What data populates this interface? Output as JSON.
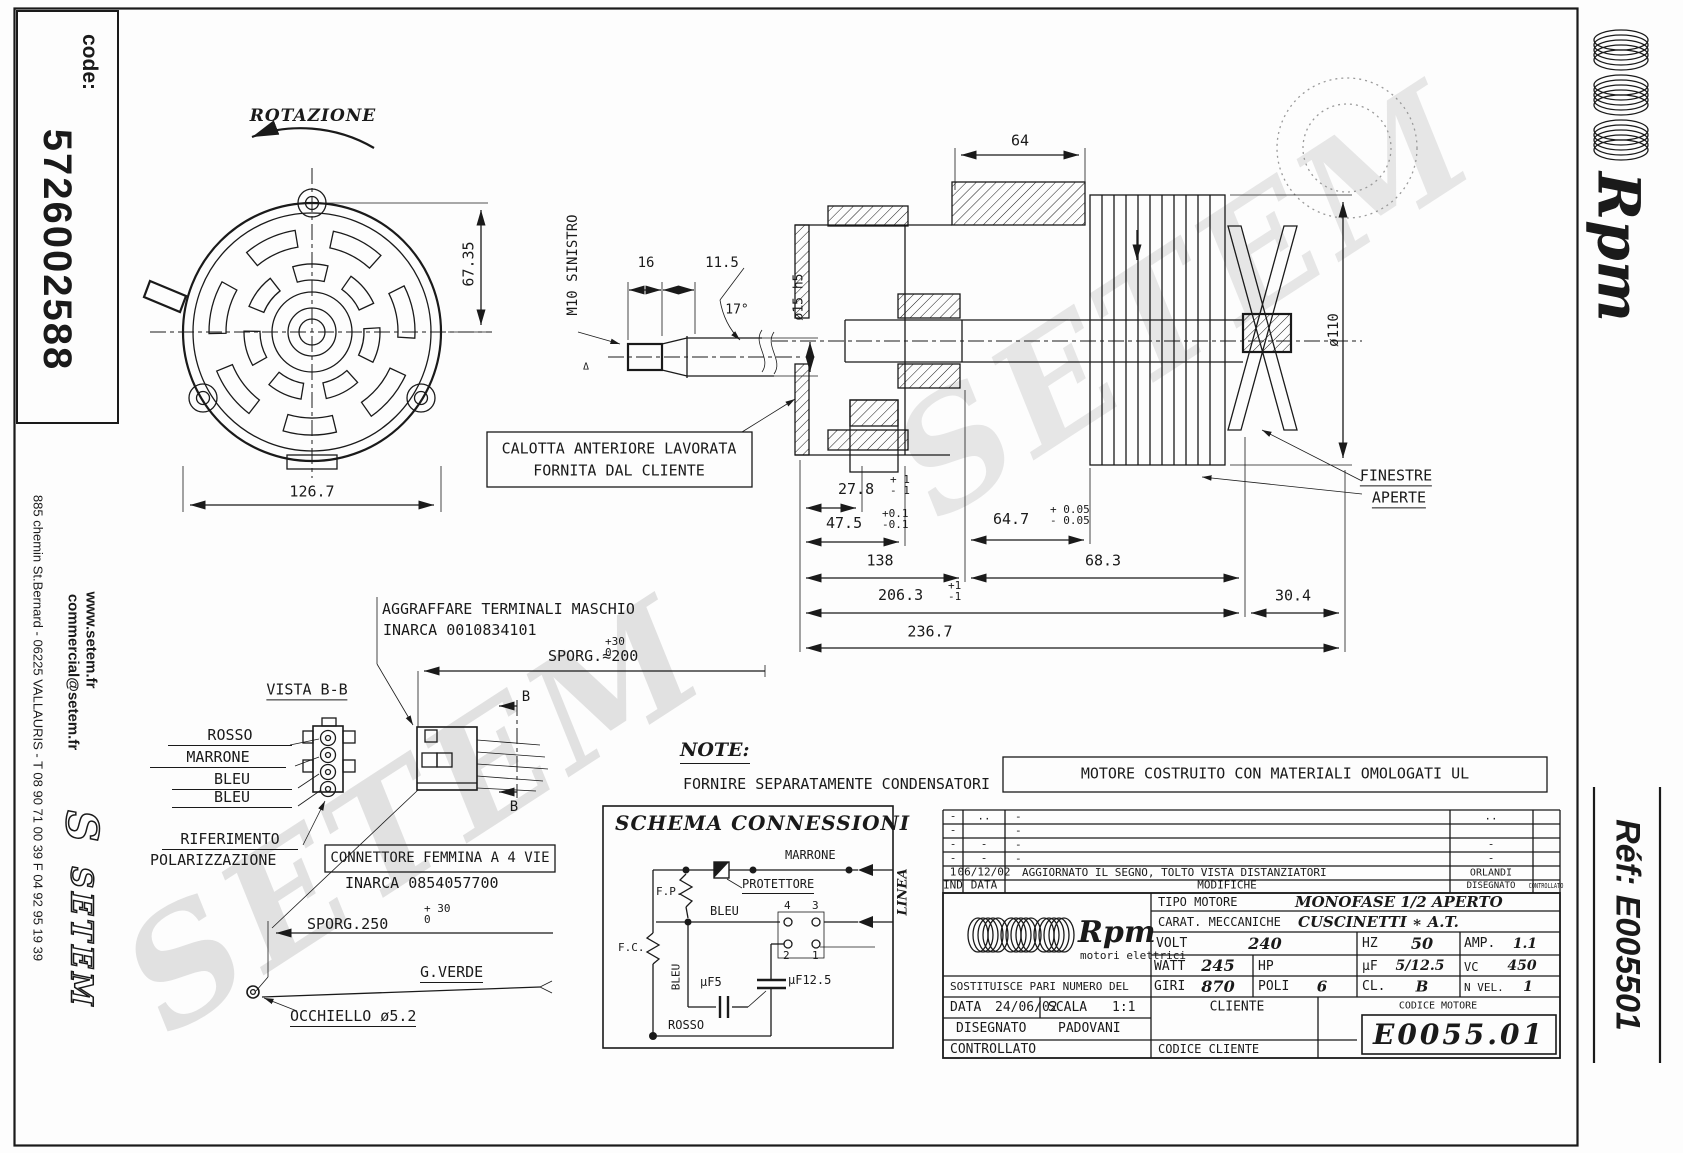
{
  "sheet": {
    "code_label": "code:",
    "code_value": "5726002588",
    "address": "885 chemin St.Bernard  -  06225 VALLAURIS  -  T 08 90 71 00 39   F 04 92 95 19 39",
    "website": "www.setem.fr",
    "email": "commercial@setem.fr",
    "setem_logo_s": "S",
    "setem_logo": "SETEM",
    "rpm_brand": "Rpm",
    "ref": "Réf:  E005501",
    "watermark": "SETEM"
  },
  "drawing": {
    "rotazione": "ROTAZIONE",
    "dim_67_35": "67.35",
    "dim_126_7": "126.7",
    "m10": "M10 SINISTRO",
    "dim_16": "16",
    "dim_11_5": "11.5",
    "angle_17": "17°",
    "dia_15": "ø15 h5",
    "delta": "Δ",
    "dim_64": "64",
    "dia_110": "ø110",
    "calotta_line1": "CALOTTA ANTERIORE LAVORATA",
    "calotta_line2": "FORNITA DAL CLIENTE",
    "finestre_line1": "FINESTRE",
    "finestre_line2": "APERTE",
    "d27_8": "27.8",
    "d27_8_p": "+ 1",
    "d27_8_m": "- 1",
    "d47_5": "47.5",
    "d47_5_p": "+0.1",
    "d47_5_m": "-0.1",
    "d64_7": "64.7",
    "d64_7_p": "+ 0.05",
    "d64_7_m": "- 0.05",
    "d138": "138",
    "d68_3": "68.3",
    "d206_3": "206.3",
    "d206_3_p": "+1",
    "d206_3_m": "-1",
    "d30_4": "30.4",
    "d236_7": "236.7",
    "aggraffare_line1": "AGGRAFFARE TERMINALI MASCHIO",
    "aggraffare_line2": "INARCA 0010834101",
    "sporg200": "SPORG.≈200",
    "sporg200_p": "+30",
    "sporg200_m": "0",
    "vista_bb": "VISTA B-B",
    "wire1": "ROSSO",
    "wire2": "MARRONE",
    "wire3": "BLEU",
    "wire4": "BLEU",
    "rif1": "RIFERIMENTO",
    "rif2": "POLARIZZAZIONE",
    "conn1": "CONNETTORE FEMMINA A 4 VIE",
    "conn2": "INARCA 0854057700",
    "sporg250": "SPORG.250",
    "sporg250_p": "+ 30",
    "sporg250_m": "0",
    "gverde": "G.VERDE",
    "occhiello": "OCCHIELLO ø5.2",
    "section_b": "B",
    "note_title": "NOTE:",
    "note_body": "FORNIRE SEPARATAMENTE CONDENSATORI",
    "ul_note": "MOTORE COSTRUITO CON MATERIALI OMOLOGATI UL"
  },
  "schema": {
    "title": "SCHEMA CONNESSIONI",
    "marrone": "MARRONE",
    "protettore": "PROTETTORE",
    "fp": "F.P.",
    "fc": "F.C.",
    "bleu": "BLEU",
    "bleu_v": "BLEU",
    "t4": "4",
    "t3": "3",
    "t2": "2",
    "t1": "1",
    "cap5": "µF5",
    "cap125": "µF12.5",
    "rosso": "ROSSO",
    "linea": "LINEA"
  },
  "revisions": {
    "rows": [
      [
        "-",
        "..",
        "-",
        "..",
        ""
      ],
      [
        "-",
        "",
        "-",
        "",
        ""
      ],
      [
        "-",
        "-",
        "-",
        "-",
        ""
      ],
      [
        "-",
        "-",
        "-",
        "-",
        ""
      ],
      [
        "1",
        "06/12/02",
        "AGGIORNATO IL SEGNO, TOLTO VISTA DISTANZIATORI",
        "ORLANDI",
        ""
      ],
      [
        "IND",
        "DATA",
        "MODIFICHE",
        "DISEGNATO",
        "CONTROLLATO"
      ]
    ]
  },
  "titleblock": {
    "brand": "Rpm",
    "brand_sub": "motori elettrici",
    "tipo_label": "TIPO MOTORE",
    "tipo_value": "MONOFASE 1/2 APERTO",
    "carat_label": "CARAT. MECCANICHE",
    "carat_value": "CUSCINETTI ∗ A.T.",
    "volt_label": "VOLT",
    "volt": "240",
    "hz_label": "HZ",
    "hz": "50",
    "amp_label": "AMP.",
    "amp": "1.1",
    "watt_label": "WATT",
    "watt": "245",
    "hp_label": "HP",
    "hp": "",
    "uf_label": "µF",
    "uf": "5/12.5",
    "vc_label": "VC",
    "vc": "450",
    "sost_label": "SOSTITUISCE PARI NUMERO DEL",
    "sost_value": "-",
    "giri_label": "GIRI",
    "giri": "870",
    "poli_label": "POLI",
    "poli": "6",
    "cl_label": "CL.",
    "cl": "B",
    "nvel_label": "N VEL.",
    "nvel": "1",
    "data_label": "DATA",
    "data_value": "24/06/02",
    "scala_label": "SCALA",
    "scala_value": "1:1",
    "cliente_label": "CLIENTE",
    "codice_motore_label": "CODICE MOTORE",
    "disegnato_label": "DISEGNATO",
    "disegnato_value": "PADOVANI",
    "controllato_label": "CONTROLLATO",
    "codice_cliente_label": "CODICE CLIENTE",
    "codice_motore_value": "E0055.01"
  }
}
